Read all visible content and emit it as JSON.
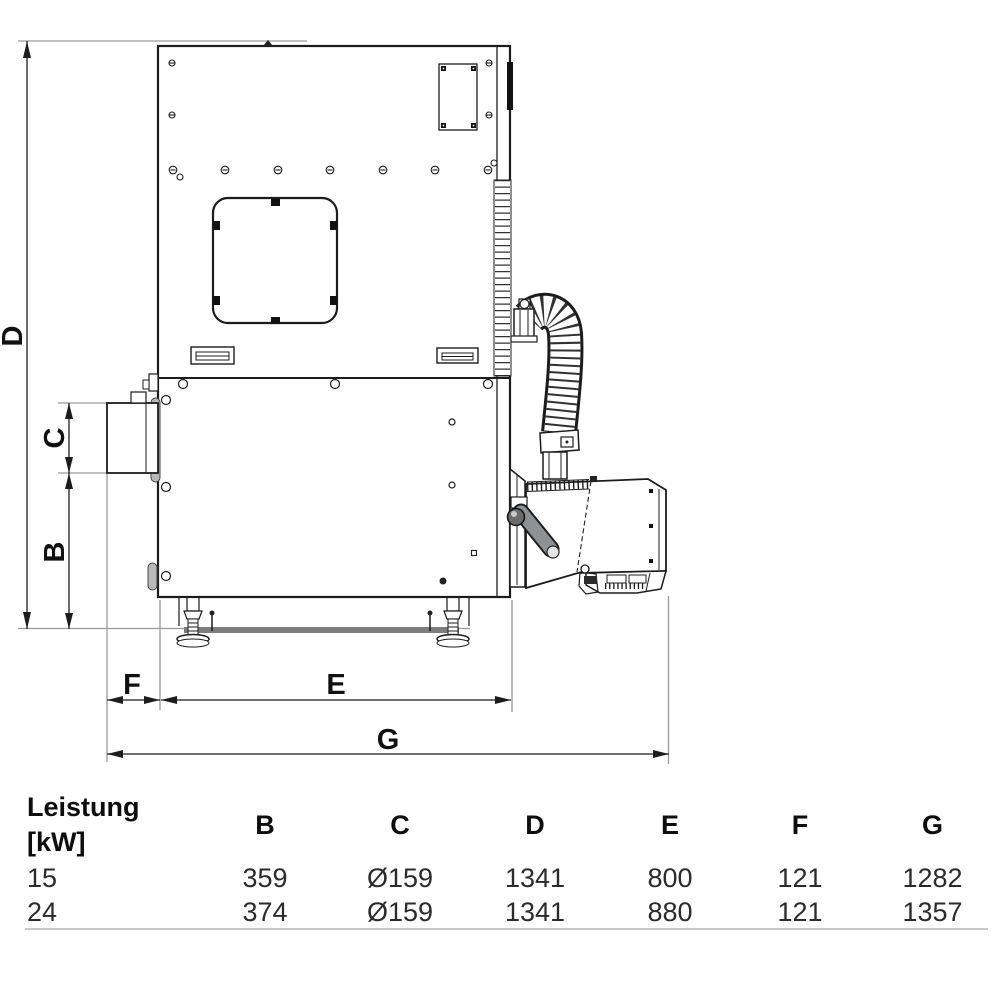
{
  "drawing": {
    "dimension_labels": {
      "d": "D",
      "c": "C",
      "b": "B",
      "f": "F",
      "e": "E",
      "g": "G"
    },
    "colors": {
      "outline": "#1c1c1c",
      "extension_line": "#9a9a9a",
      "base_bar": "#7d7d7d"
    }
  },
  "table": {
    "header": {
      "power_label_line1": "Leistung",
      "power_label_line2": "[kW]",
      "columns": [
        "B",
        "C",
        "D",
        "E",
        "F",
        "G"
      ]
    },
    "rows": [
      {
        "power": "15",
        "B": "359",
        "C": "Ø159",
        "D": "1341",
        "E": "800",
        "F": "121",
        "G": "1282"
      },
      {
        "power": "24",
        "B": "374",
        "C": "Ø159",
        "D": "1341",
        "E": "880",
        "F": "121",
        "G": "1357"
      }
    ]
  }
}
